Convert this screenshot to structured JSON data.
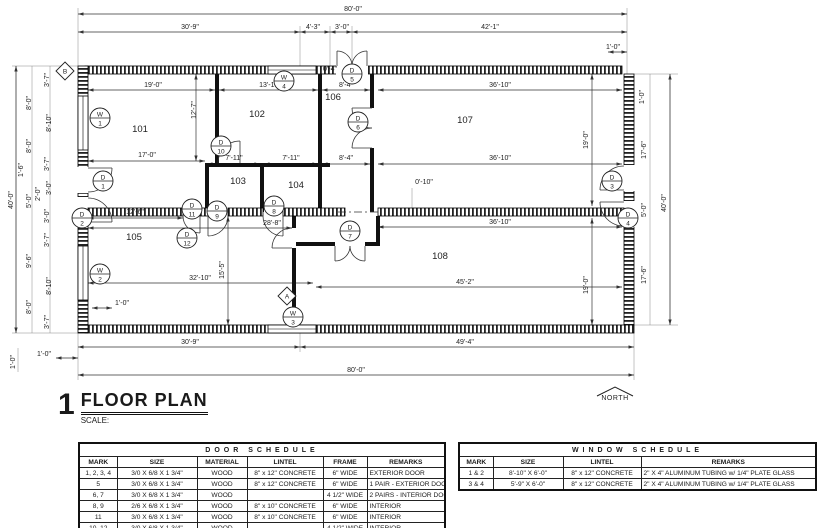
{
  "plan": {
    "number": "1",
    "title": "FLOOR PLAN",
    "scale_label": "SCALE:",
    "north": "NORTH",
    "rooms": [
      "101",
      "102",
      "103",
      "104",
      "105",
      "106",
      "107",
      "108"
    ],
    "doors": [
      {
        "k": "D",
        "n": "1"
      },
      {
        "k": "D",
        "n": "2"
      },
      {
        "k": "D",
        "n": "3"
      },
      {
        "k": "D",
        "n": "4"
      },
      {
        "k": "D",
        "n": "5"
      },
      {
        "k": "D",
        "n": "6"
      },
      {
        "k": "D",
        "n": "7"
      },
      {
        "k": "D",
        "n": "8"
      },
      {
        "k": "D",
        "n": "9"
      },
      {
        "k": "D",
        "n": "10"
      },
      {
        "k": "D",
        "n": "11"
      },
      {
        "k": "D",
        "n": "12"
      }
    ],
    "windows": [
      {
        "k": "W",
        "n": "1"
      },
      {
        "k": "W",
        "n": "2"
      },
      {
        "k": "W",
        "n": "3"
      },
      {
        "k": "W",
        "n": "4"
      }
    ],
    "markers": [
      "B",
      "A"
    ],
    "dims": {
      "overall_w": "80'-0\"",
      "top": [
        "30'-9\"",
        "4'-3\"",
        "3'-0\"",
        "42'-1\""
      ],
      "inner_top": [
        "19'-0\"",
        "13'-10\"",
        "8'-4\"",
        "36'-10\"",
        "12'-7\"",
        "0'-4\""
      ],
      "mid": [
        "17'-0\"",
        "7'-11\"",
        "7'-11\"",
        "8'-4\"",
        "36'-10\""
      ],
      "low_mid": [
        "12'-6\"",
        "28'-8\"",
        "0'-10\"",
        "36'-10\""
      ],
      "bottom_inner": [
        "32'-10\"",
        "15'-5\"",
        "1'-0\"",
        "45'-2\""
      ],
      "right_inner": [
        "19'-0\"",
        "19'-0\""
      ],
      "bottom": [
        "30'-9\"",
        "49'-4\"",
        "80'-0\"",
        "1'-0\"",
        "1'-0\""
      ],
      "left": [
        "3'-7\"",
        "8'-0\"",
        "8'-10\"",
        "8'-0\"",
        "3'-7\"",
        "1'-6\"",
        "2'-0\"",
        "3'-0\"",
        "5'-0\"",
        "3'-0\"",
        "3'-7\"",
        "9'-6\"",
        "8'-10\"",
        "8'-0\"",
        "3'-7\"",
        "40'-0\""
      ],
      "right": [
        "1'-0\"",
        "1'-0\"",
        "17'-6\"",
        "5'-0\"",
        "17'-6\"",
        "40'-0\""
      ]
    }
  },
  "door_schedule": {
    "title": "DOOR SCHEDULE",
    "headers": [
      "MARK",
      "SIZE",
      "MATERIAL",
      "LINTEL",
      "FRAME",
      "REMARKS"
    ],
    "rows": [
      {
        "mark": "1, 2, 3, 4",
        "size": "3/0 X 6/8 X 1 3/4\"",
        "material": "WOOD",
        "lintel": "8\" x 12\" CONCRETE",
        "frame": "6\" WIDE",
        "remarks": "EXTERIOR DOOR"
      },
      {
        "mark": "5",
        "size": "3/0 X 6/8 X 1 3/4\"",
        "material": "WOOD",
        "lintel": "8\" x 12\" CONCRETE",
        "frame": "6\" WIDE",
        "remarks": "1 PAIR - EXTERIOR DOOR"
      },
      {
        "mark": "6, 7",
        "size": "3/0 X 6/8 X 1 3/4\"",
        "material": "WOOD",
        "lintel": "",
        "frame": "4 1/2\" WIDE",
        "remarks": "2 PAIRS - INTERIOR DOORS"
      },
      {
        "mark": "8, 9",
        "size": "2/6 X 6/8 X 1 3/4\"",
        "material": "WOOD",
        "lintel": "8\" x 10\" CONCRETE",
        "frame": "6\" WIDE",
        "remarks": "INTERIOR"
      },
      {
        "mark": "11",
        "size": "3/0 X 6/8 X 1 3/4\"",
        "material": "WOOD",
        "lintel": "8\" x 10\" CONCRETE",
        "frame": "6\" WIDE",
        "remarks": "INTERIOR"
      },
      {
        "mark": "10, 12",
        "size": "3/0 X 6/8 X 1 3/4\"",
        "material": "WOOD",
        "lintel": "",
        "frame": "4 1/2\" WIDE",
        "remarks": "INTERIOR"
      }
    ]
  },
  "window_schedule": {
    "title": "WINDOW SCHEDULE",
    "headers": [
      "MARK",
      "SIZE",
      "LINTEL",
      "REMARKS"
    ],
    "rows": [
      {
        "mark": "1 & 2",
        "size": "8'-10\" X 6'-0\"",
        "lintel": "8\" x 12\" CONCRETE",
        "remarks": "2\" X 4\" ALUMINUM TUBING w/ 1/4\" PLATE GLASS"
      },
      {
        "mark": "3 & 4",
        "size": "5'-9\" X 6'-0\"",
        "lintel": "8\" x 12\" CONCRETE",
        "remarks": "2\" X 4\" ALUMINUM TUBING w/ 1/4\" PLATE GLASS"
      }
    ]
  }
}
